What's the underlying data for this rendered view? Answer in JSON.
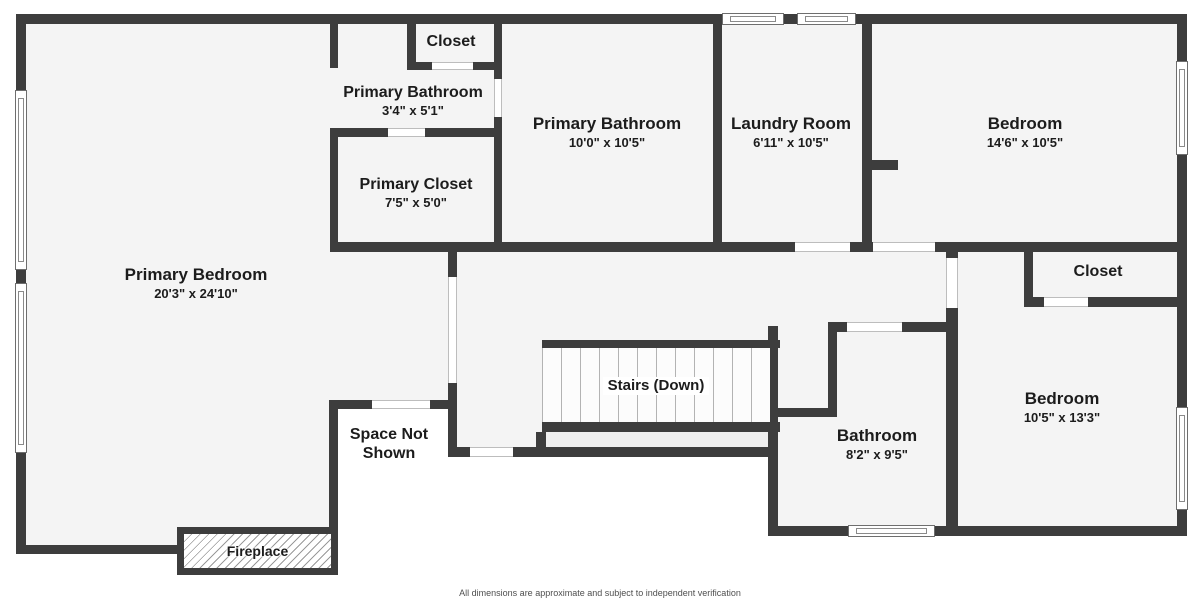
{
  "colors": {
    "wall": "#3d3d3d",
    "floor": "#f4f4f4",
    "treads": "#fcfcfc",
    "stair_strip": "#efefef",
    "label_text": "#1c1c1c",
    "footer_text": "#4f4f4f",
    "background": "#ffffff"
  },
  "rooms": {
    "primary_bedroom": {
      "name": "Primary Bedroom",
      "dims": "20'3\" x 24'10\""
    },
    "top_closet": {
      "name": "Closet"
    },
    "primary_bathroom_small": {
      "name": "Primary Bathroom",
      "dims": "3'4\" x 5'1\""
    },
    "primary_closet": {
      "name": "Primary Closet",
      "dims": "7'5\" x 5'0\""
    },
    "primary_bathroom": {
      "name": "Primary Bathroom",
      "dims": "10'0\" x 10'5\""
    },
    "laundry_room": {
      "name": "Laundry Room",
      "dims": "6'11\" x 10'5\""
    },
    "bedroom_top": {
      "name": "Bedroom",
      "dims": "14'6\" x 10'5\""
    },
    "right_closet": {
      "name": "Closet"
    },
    "bedroom_bottom": {
      "name": "Bedroom",
      "dims": "10'5\" x 13'3\""
    },
    "bathroom": {
      "name": "Bathroom",
      "dims": "8'2\" x 9'5\""
    },
    "stairs": {
      "name": "Stairs (Down)"
    },
    "space_not_shown": {
      "line1": "Space Not",
      "line2": "Shown"
    },
    "fireplace": {
      "name": "Fireplace"
    }
  },
  "footer": {
    "disclaimer": "All dimensions are approximate and subject to independent verification"
  }
}
